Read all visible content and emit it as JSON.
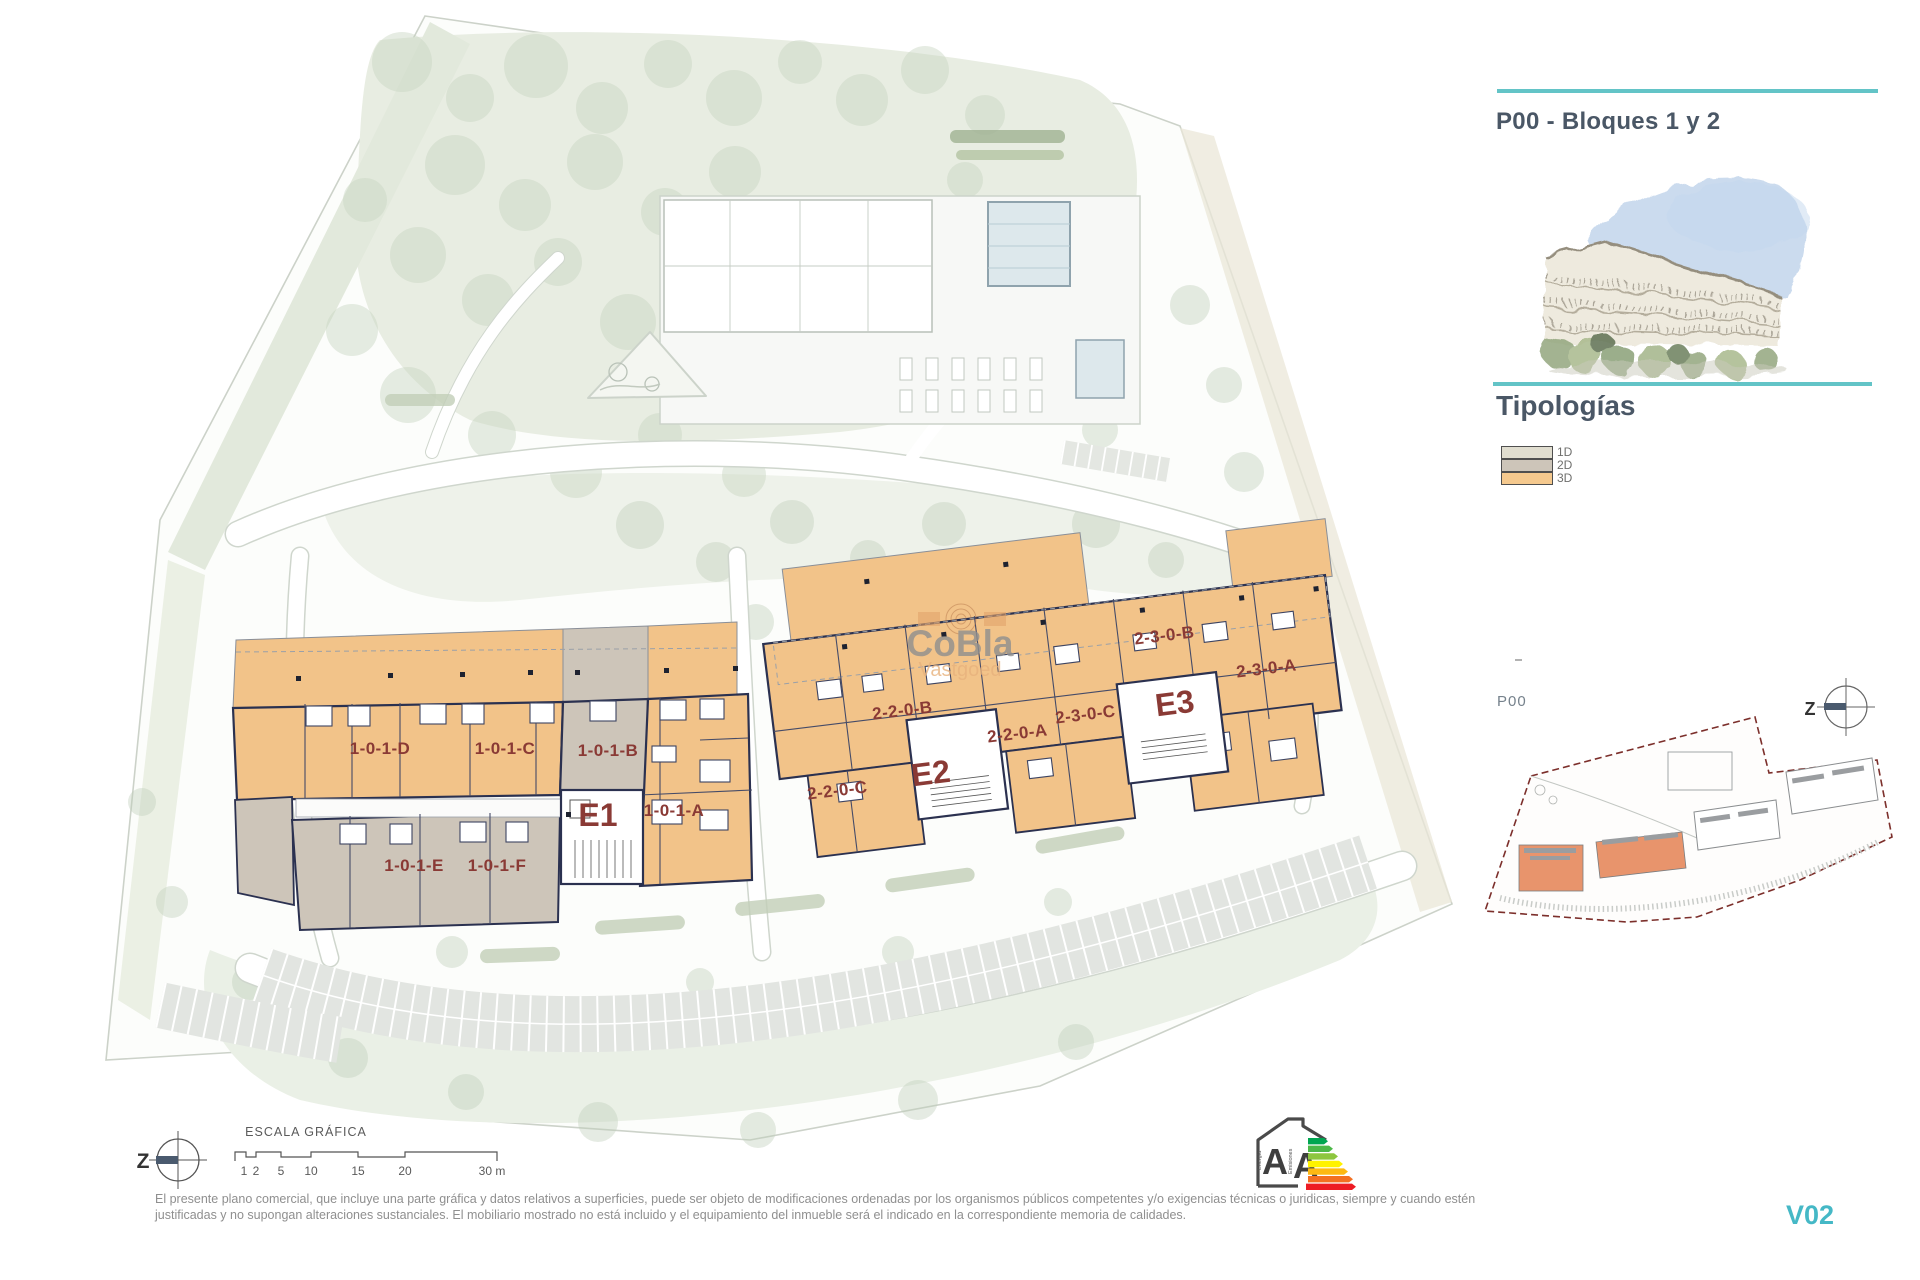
{
  "panel": {
    "title": "P00 - Bloques 1 y 2",
    "typologies_heading": "Tipologías",
    "legend": [
      {
        "label": "1D",
        "color": "#e0ddcf"
      },
      {
        "label": "2D",
        "color": "#cdc5b9"
      },
      {
        "label": "3D",
        "color": "#f5c98e"
      }
    ],
    "key_plan": {
      "floor_label": "P00",
      "north_letter": "Z"
    }
  },
  "plan": {
    "watermark": {
      "brand": "CoBla",
      "sub": "Vastgoed"
    },
    "north_letter": "Z",
    "blocks": {
      "e1": {
        "core": "E1",
        "units": [
          "1-0-1-D",
          "1-0-1-C",
          "1-0-1-B",
          "1-0-1-A",
          "1-0-1-E",
          "1-0-1-F"
        ]
      },
      "e2": {
        "core": "E2",
        "units": [
          "2-2-0-B",
          "2-2-0-A",
          "2-2-0-C"
        ]
      },
      "e3": {
        "core": "E3",
        "units": [
          "2-3-0-B",
          "2-3-0-C",
          "2-3-0-A"
        ]
      }
    },
    "scale_bar": {
      "title": "ESCALA GRÁFICA",
      "ticks": [
        "1",
        "2",
        "5",
        "10",
        "15",
        "20",
        "30 m"
      ]
    }
  },
  "energy": {
    "scale_labels": [
      "A",
      "A"
    ],
    "axes": [
      "Energía",
      "Emisiones"
    ],
    "colors": [
      "#00a651",
      "#4cb848",
      "#8dc63f",
      "#fff200",
      "#fdb913",
      "#f37021",
      "#ed1c24"
    ]
  },
  "footer": {
    "disclaimer": "El presente plano comercial, que incluye una parte gráfica y datos relativos a superficies, puede ser objeto de modificaciones ordenadas por los organismos públicos competentes y/o exigencias técnicas o juridicas, siempre y cuando estén justificadas y no supongan alteraciones sustanciales. El mobiliario mostrado no está incluido y el equipamiento del inmueble será el indicado en la correspondiente memoria de calidades.",
    "version": "V02"
  },
  "colors": {
    "accent_teal": "#63c4c7",
    "label_red": "#8a3a35",
    "wall_dark": "#2b3150",
    "typology_3d_fill": "#f2c389",
    "typology_2d_fill": "#cdc5b9",
    "keyplan_boundary_red": "#7c2f2b",
    "keyplan_highlight_orange": "#e8946c"
  }
}
